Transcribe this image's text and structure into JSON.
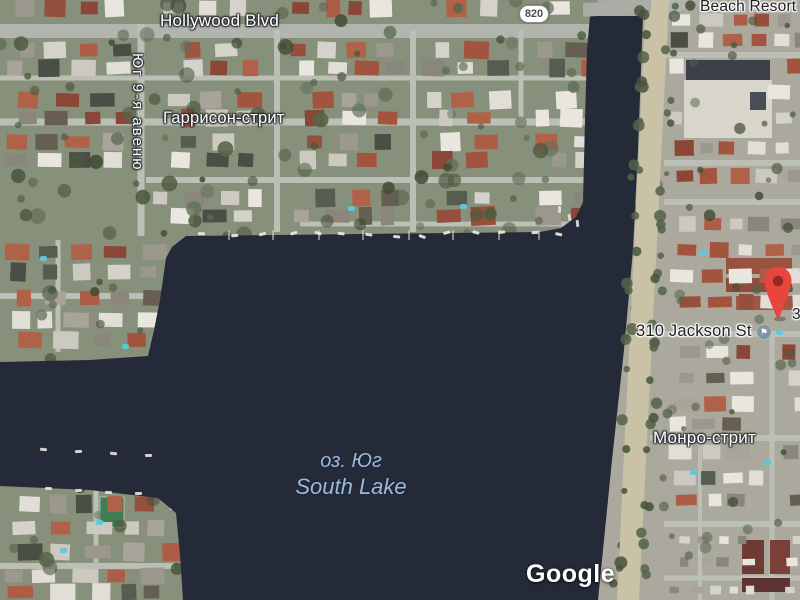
{
  "map_labels": {
    "hollywood_blvd": "Hollywood Blvd",
    "route_820": "820",
    "beach_resort": "Beach Resort",
    "ave_9_south": "Юг 9-я авеню",
    "harrison_st": "Гаррисон-стрит",
    "jackson_address": "310 Jackson St",
    "jackson_cutoff": "3",
    "monroe_st": "Монро-стрит",
    "lake_name_ru": "оз. Юг",
    "lake_name_en": "South Lake"
  },
  "watermark": {
    "brand": "Google"
  },
  "icons": {
    "marker": "map-pin-icon",
    "poi_badge": "poi-flag-icon",
    "route_shield": "route-shield-oval"
  },
  "colors": {
    "water": "#242a38",
    "land": "#87907a",
    "urban": "#aba99e",
    "road": "#bcbfb6",
    "road_major": "#b2b5ae",
    "bank_road": "#c9c2a6",
    "pin_red": "#e8453c",
    "pin_hole": "#8f2a25",
    "water_label": "#9cb9dc",
    "label_dark": "#1f2023"
  }
}
